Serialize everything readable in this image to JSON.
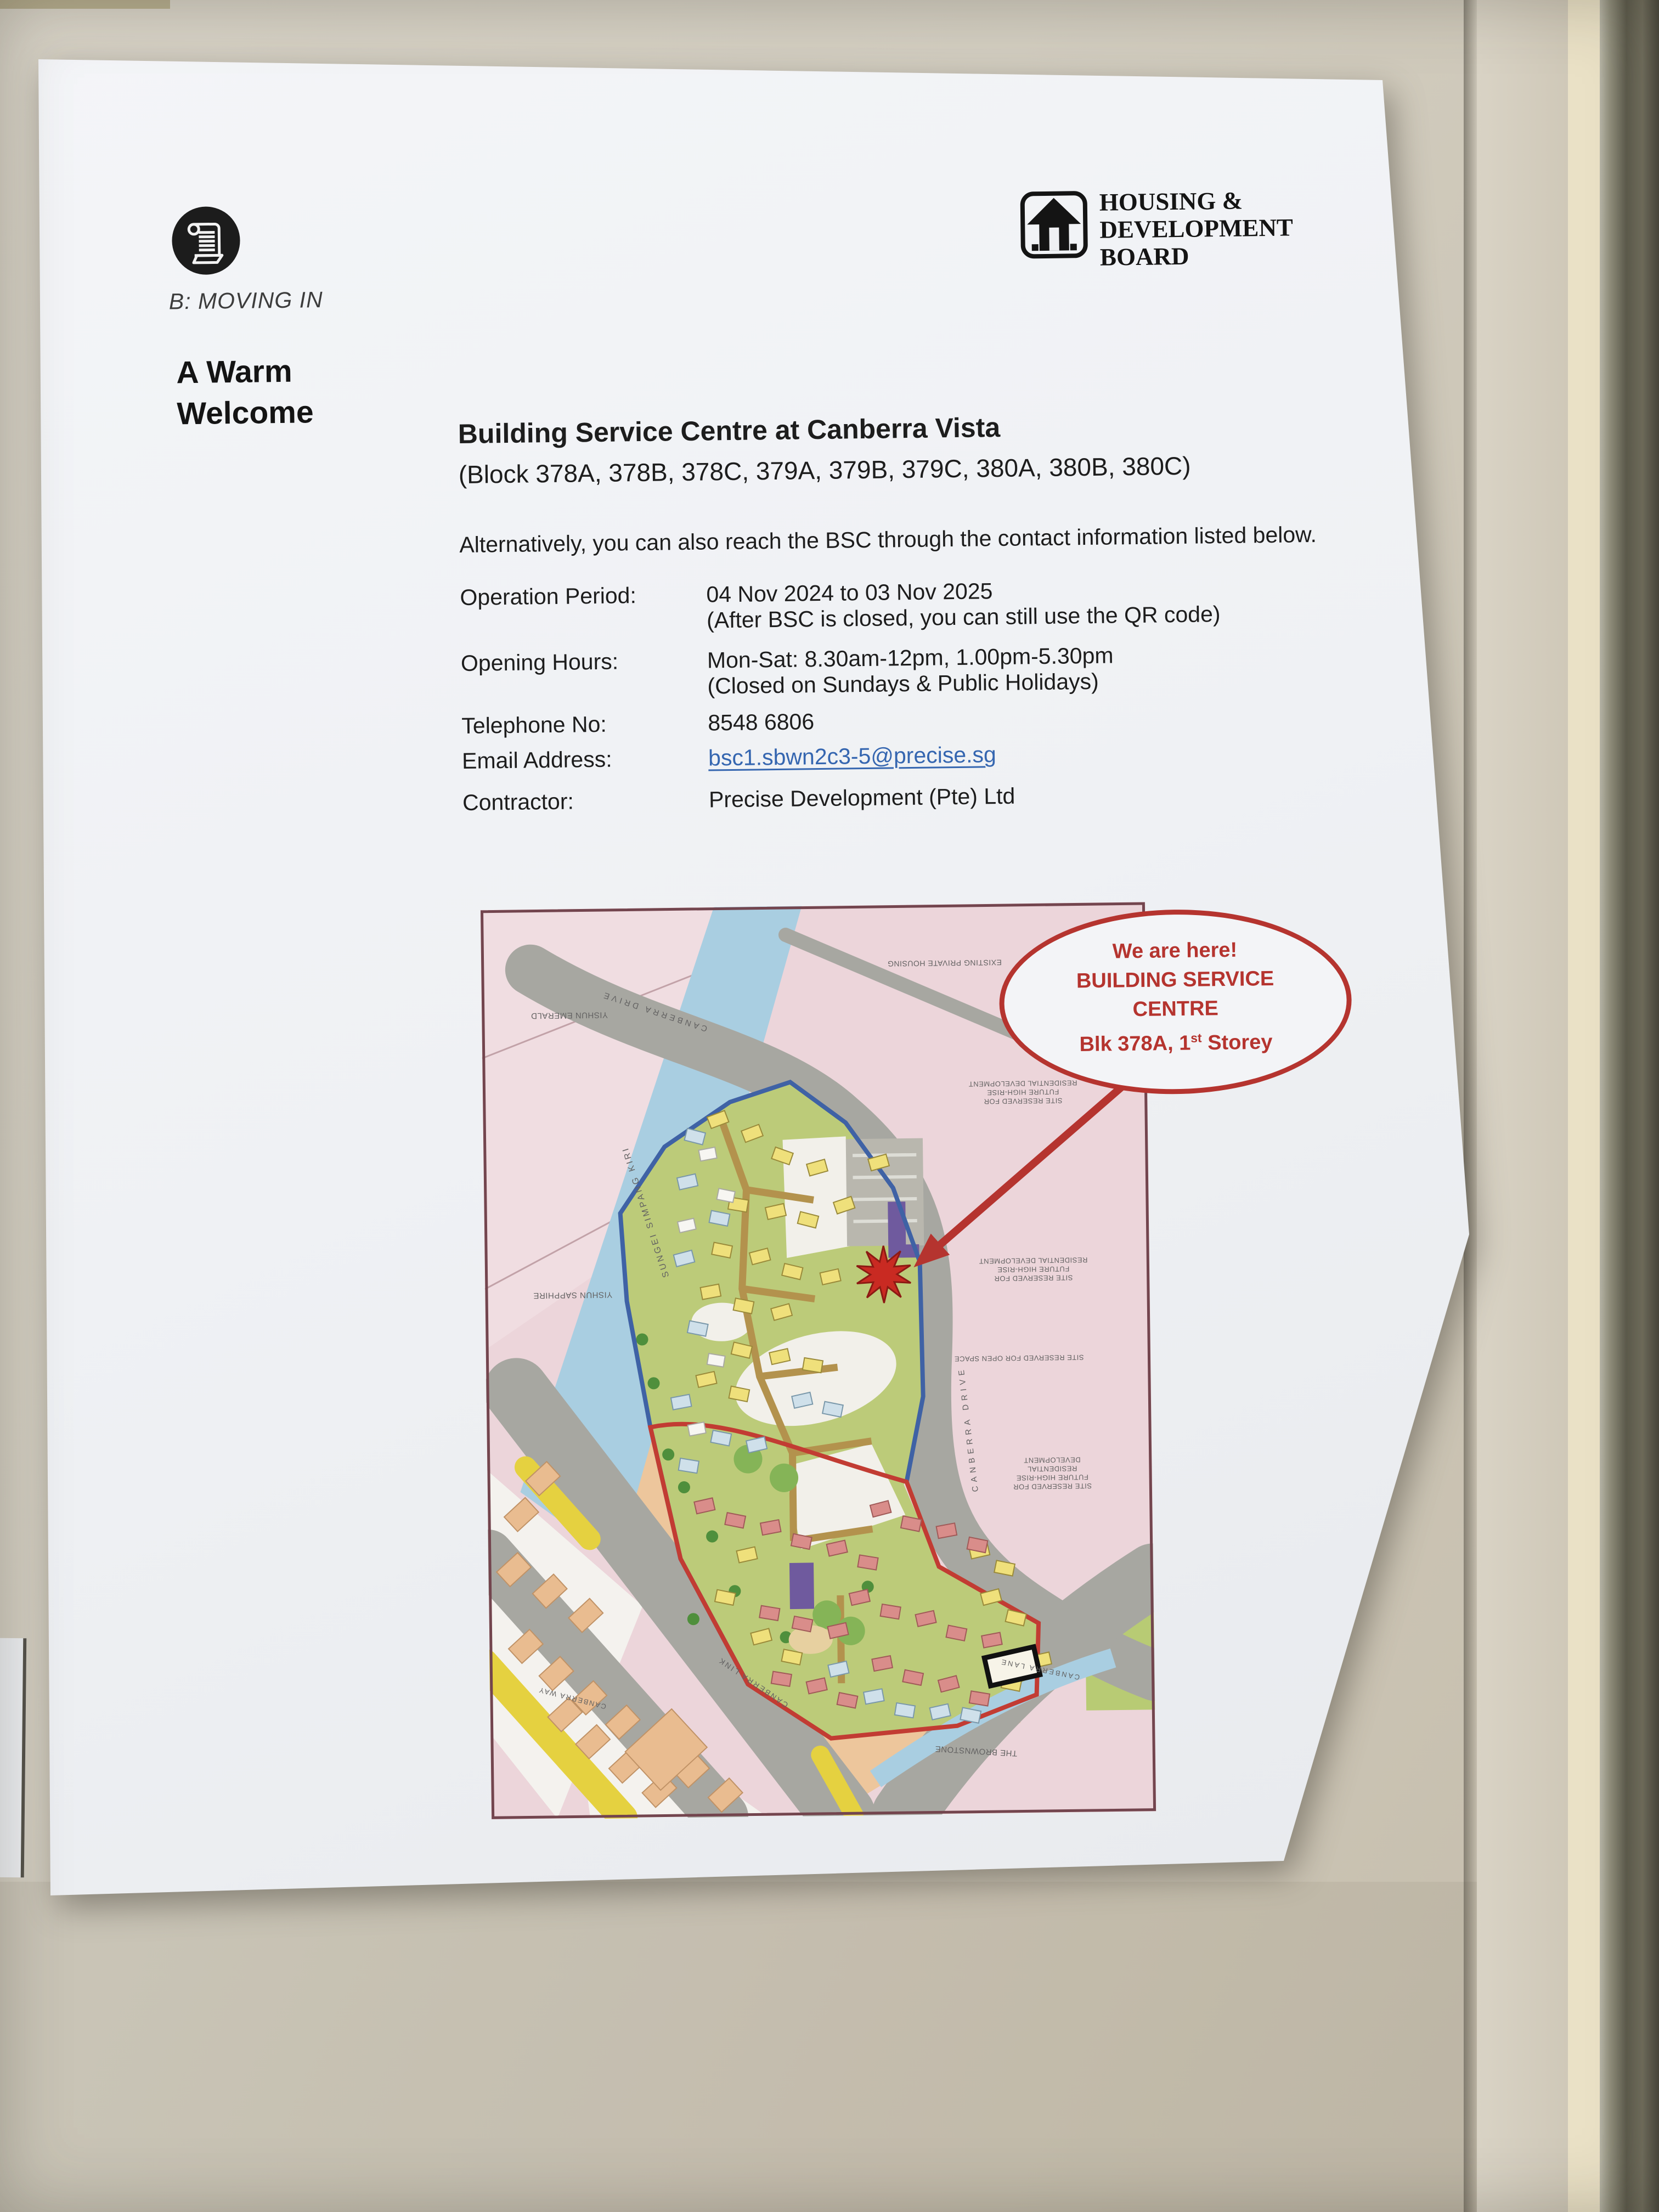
{
  "header": {
    "section_label": "B: MOVING IN",
    "welcome_line1": "A Warm",
    "welcome_line2": "Welcome",
    "hdb": {
      "line1": "HOUSING &",
      "line2": "DEVELOPMENT",
      "line3": "BOARD"
    }
  },
  "notice": {
    "title": "Building Service Centre at Canberra Vista",
    "block_list": "(Block 378A, 378B, 378C, 379A, 379B, 379C, 380A, 380B, 380C)",
    "intro": "Alternatively, you can also reach the BSC through the contact information listed below.",
    "details": [
      {
        "label": "Operation Period:",
        "value": "04 Nov 2024 to 03 Nov 2025",
        "note": "(After BSC is closed, you can still use the QR code)"
      },
      {
        "label": "Opening Hours:",
        "value": "Mon-Sat: 8.30am-12pm, 1.00pm-5.30pm",
        "note": "(Closed on Sundays & Public Holidays)"
      },
      {
        "label": "Telephone No:",
        "value": "8548 6806"
      },
      {
        "label": "Email Address:",
        "value": "bsc1.sbwn2c3-5@precise.sg"
      },
      {
        "label": "Contractor:",
        "value": "Precise Development (Pte) Ltd"
      }
    ],
    "email_color": "#3566b0"
  },
  "map": {
    "callout": {
      "line1": "We are here!",
      "line2": "BUILDING SERVICE",
      "line3": "CENTRE",
      "line4_pre": "Blk 378A, 1",
      "line4_sup": "st",
      "line4_post": " Storey",
      "color": "#b5342f"
    },
    "labels": [
      {
        "text": "YISHUN EMERALD"
      },
      {
        "text": "YISHUN SAPPHIRE"
      },
      {
        "text": "SUNGEI  SIMPANG  KIRI"
      },
      {
        "text": "CANBERRA  DRIVE"
      },
      {
        "text": "CANBERRA  DRIVE"
      },
      {
        "text": "EXISTING PRIVATE HOUSING"
      },
      {
        "text": "SITE RESERVED FOR\nFUTURE HIGH-RISE\nRESIDENTIAL DEVELOPMENT"
      },
      {
        "text": "SITE RESERVED FOR\nFUTURE HIGH-RISE\nRESIDENTIAL DEVELOPMENT"
      },
      {
        "text": "SITE RESERVED FOR OPEN SPACE"
      },
      {
        "text": "SITE RESERVED FOR\nFUTURE HIGH-RISE\nRESIDENTIAL DEVELOPMENT"
      },
      {
        "text": "THE BROWNSTONE"
      },
      {
        "text": "CANBERRA  LANE"
      },
      {
        "text": "CANBERRA  LINK"
      },
      {
        "text": "CANBERRA  WAY"
      }
    ]
  }
}
